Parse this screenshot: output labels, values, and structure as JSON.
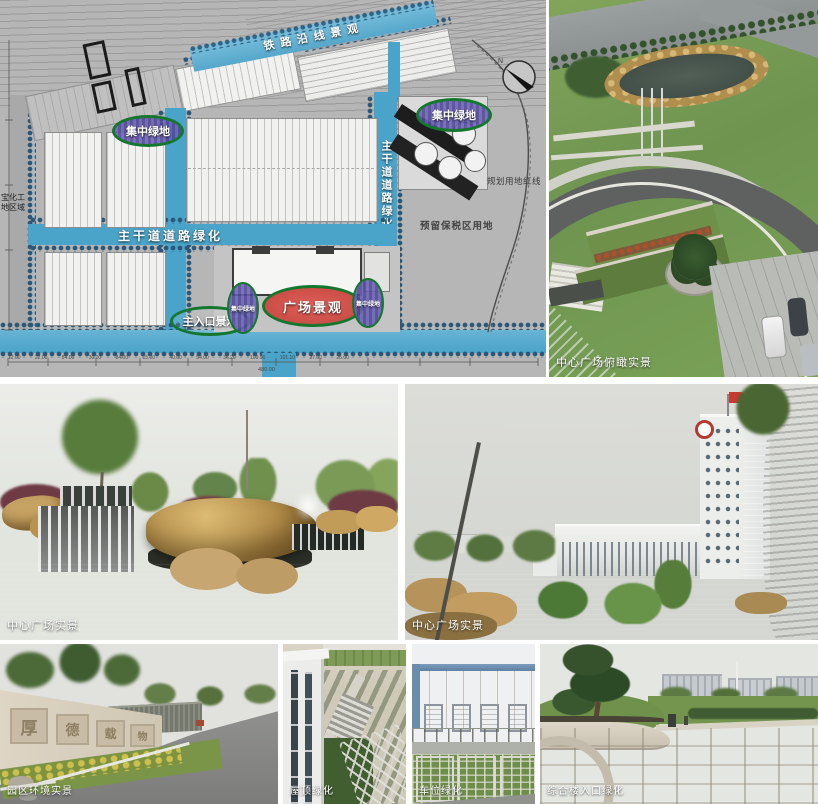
{
  "plan": {
    "labels": {
      "railway": "铁路沿线景观",
      "green_left": "集中绿地",
      "green_right": "集中绿地",
      "road_h": "主干道道路绿化",
      "road_v": "主干道道路绿化",
      "entrance": "主入口景观",
      "plaza": "广场景观",
      "green_small_left": "集中绿地",
      "green_small_right": "集中绿地",
      "red_line": "规划用地红线",
      "reserved": "预留保税区用地",
      "side_line1": "宝化工",
      "side_line2": "地区域",
      "north": "N",
      "dims": "12.00 22.00 84.00 30.00 84.00 15.00 40.00 54.00 36.20 109.90 101.10 27.00 25.00",
      "total": "480.00"
    },
    "colors": {
      "road_blue": "#4aa3c8",
      "band_blue": "#6cb5d4",
      "label_green": "#15772e",
      "label_purple": "#6a61b5",
      "plaza_red": "#d14f4a",
      "plan_bg": "#b6b6b6"
    }
  },
  "photos": {
    "aerial": {
      "caption": "中心广场俯瞰实景"
    },
    "waterfall": {
      "caption": "中心广场实景"
    },
    "office": {
      "caption": "中心广场实景"
    },
    "wall": {
      "caption": "园区环境实景",
      "panels": [
        "厚",
        "德",
        "载",
        "物"
      ]
    },
    "roof": {
      "caption": "屋顶绿化"
    },
    "parking": {
      "caption": "车位绿化"
    },
    "entrance": {
      "caption": "综合楼入口绿化"
    }
  }
}
